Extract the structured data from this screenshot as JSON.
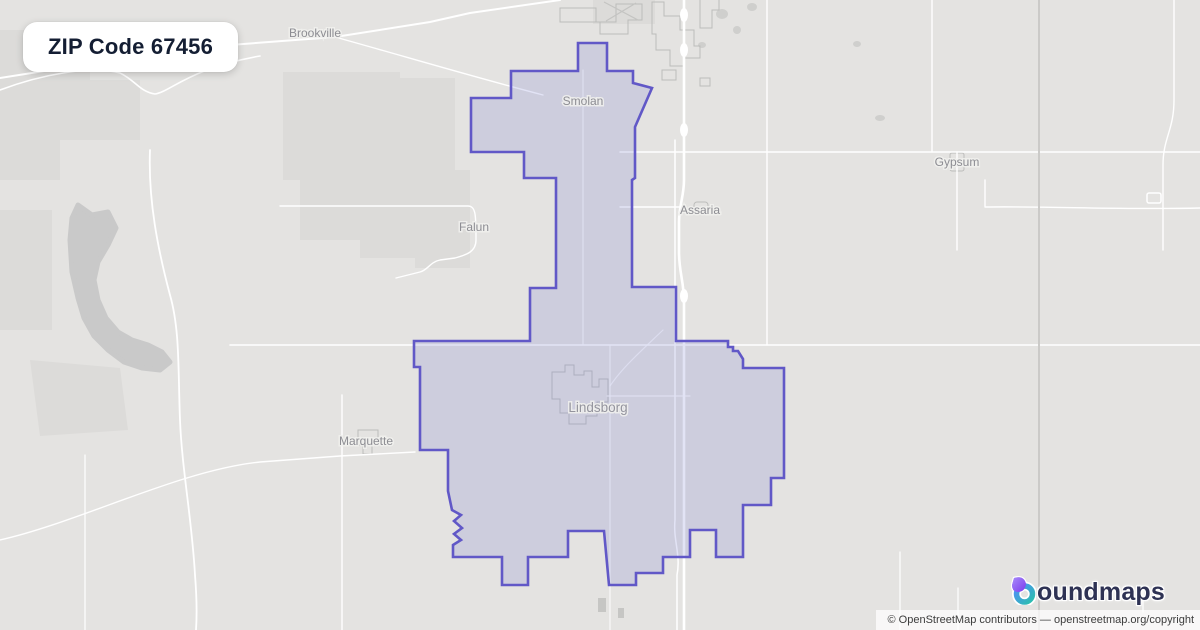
{
  "badge": {
    "label": "ZIP Code 67456"
  },
  "map": {
    "region": "Lindsborg, Kansas area",
    "towns": [
      {
        "name": "Brookville"
      },
      {
        "name": "Smolan"
      },
      {
        "name": "Falun"
      },
      {
        "name": "Assaria"
      },
      {
        "name": "Gypsum"
      },
      {
        "name": "Marquette"
      },
      {
        "name": "Lindsborg"
      }
    ],
    "zip_boundary_points": "578,43 607,43 607,71 633,71 633,83 652,88 635,127 635,178 632,180 632,287 676,287 676,341 728,341 728,347 733,347 733,351 738,351 743,359 743,368 784,368 784,478 771,478 771,505 743,505 743,557 716,557 716,530 690,530 690,557 663,557 663,573 636,573 636,585 609,585 604,531 568,531 568,557 528,557 528,585 502,585 502,557 453,557 453,545 461,540 454,534 462,528 454,521 461,515 452,510 448,491 448,450 420,450 420,367 414,367 414,341 530,341 530,288 556,288 556,178 524,178 524,152 471,152 471,98 511,98 511,71 578,71",
    "colors": {
      "boundary_stroke": "#6158C7",
      "boundary_fill": "rgba(122,127,208,0.22)",
      "background": "#e4e3e1",
      "road": "#ffffff",
      "label": "#8d8d93",
      "water": "#c9c9c9"
    }
  },
  "logo": {
    "brand": "boundmaps",
    "text_after_icon": "oundmaps",
    "icon_colors": {
      "purple": "#8b5cf6",
      "blue": "#4f8ef7",
      "teal": "#2bbfae",
      "navy": "#2e3254"
    }
  },
  "attribution": {
    "text": "© OpenStreetMap contributors — openstreetmap.org/copyright"
  }
}
